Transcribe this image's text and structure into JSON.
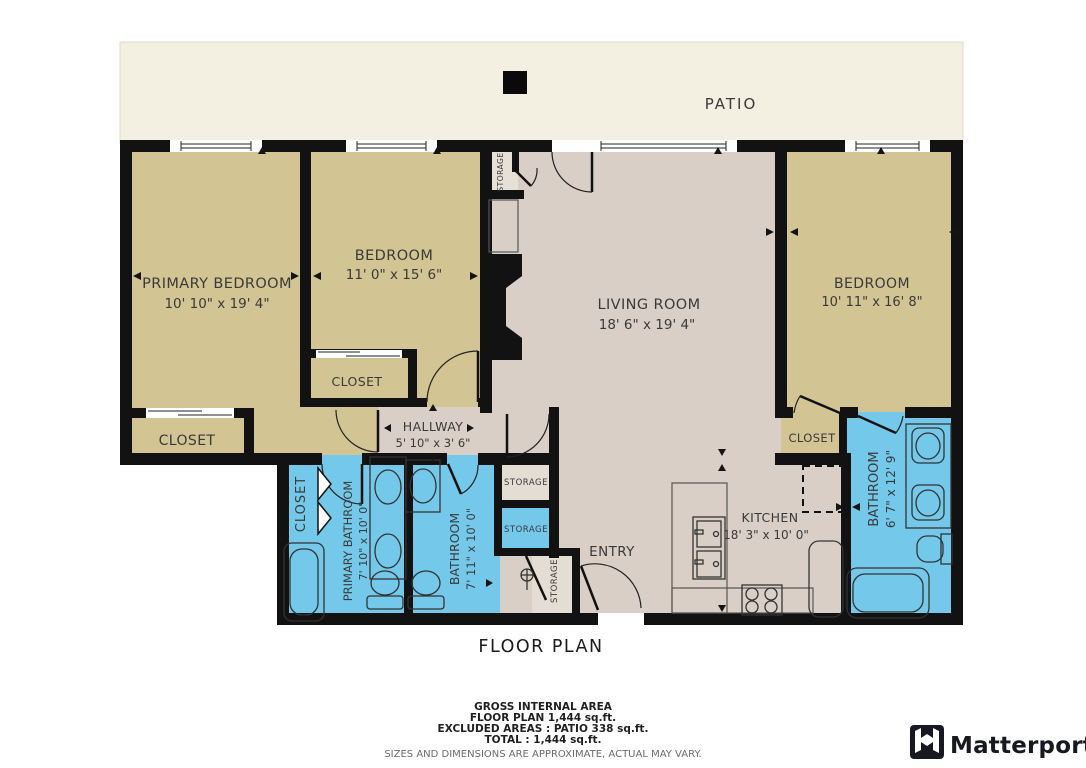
{
  "title": "FLOOR PLAN",
  "rooms": {
    "patio": {
      "name": "PATIO"
    },
    "primary_bedroom": {
      "name": "PRIMARY BEDROOM",
      "dims": "10' 10\" x 19' 4\""
    },
    "bedroom_2": {
      "name": "BEDROOM",
      "dims": "11' 0\" x 15' 6\""
    },
    "living_room": {
      "name": "LIVING ROOM",
      "dims": "18' 6\" x 19' 4\""
    },
    "bedroom_3": {
      "name": "BEDROOM",
      "dims": "10' 11\" x 16' 8\""
    },
    "hallway": {
      "name": "HALLWAY",
      "dims": "5' 10\" x 3' 6\""
    },
    "kitchen": {
      "name": "KITCHEN",
      "dims": "18' 3\" x 10' 0\""
    },
    "primary_bathroom": {
      "name": "PRIMARY BATHROOM",
      "dims": "7' 10\" x 10' 0\""
    },
    "bathroom_2": {
      "name": "BATHROOM",
      "dims": "7' 11\" x 10' 0\""
    },
    "bathroom_3": {
      "name": "BATHROOM",
      "dims": "6' 7\" x 12' 9\""
    },
    "entry": {
      "name": "ENTRY"
    }
  },
  "labels": {
    "closet": "CLOSET",
    "storage": "STORAGE"
  },
  "footer": {
    "gross_internal_area": "GROSS INTERNAL AREA",
    "floor_plan_area": "FLOOR PLAN 1,444 sq.ft.",
    "excluded_areas": "EXCLUDED AREAS :  PATIO 338 sq.ft.",
    "total": "TOTAL :  1,444 sq.ft.",
    "disclaimer": "SIZES AND DIMENSIONS ARE APPROXIMATE, ACTUAL MAY VARY."
  },
  "brand": {
    "name": "Matterport"
  },
  "colors": {
    "bedroom_tan": "#d2c493",
    "living_pink": "#dacfc6",
    "bathroom_blue": "#74c8e9",
    "patio_cream": "#f3efe1",
    "storage_gray": "#e3ddd3",
    "wall_black": "#121212"
  }
}
